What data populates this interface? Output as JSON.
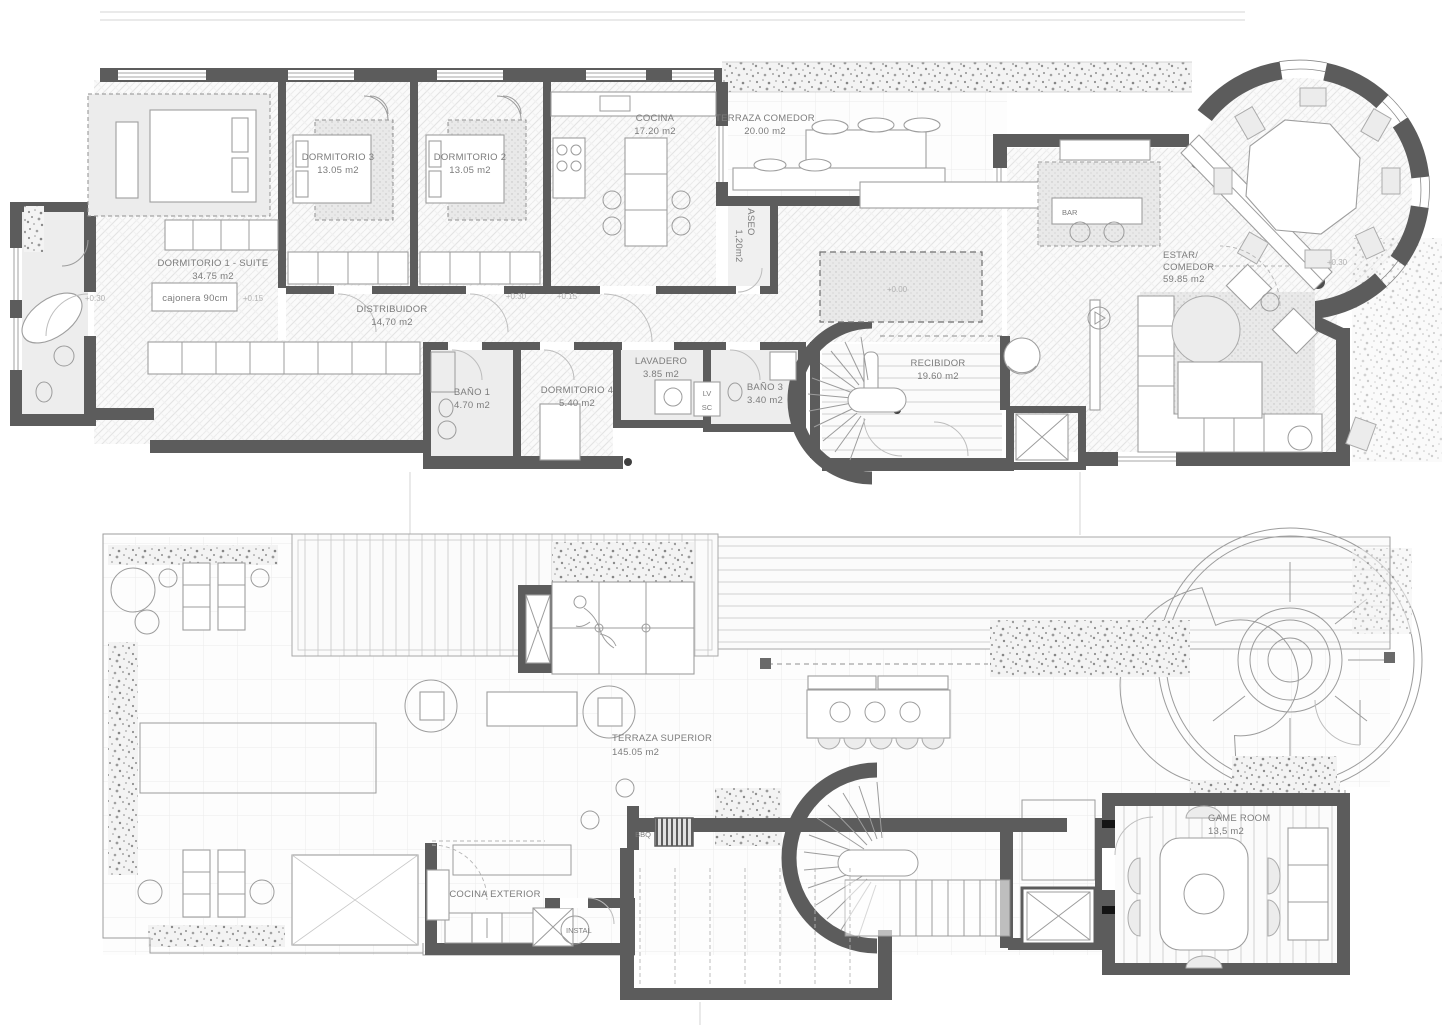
{
  "style": {
    "wall_color": "#5c5c5c",
    "label_color": "#7c7c7c",
    "level_label_color": "#b2b2b2"
  },
  "upper": {
    "rooms": {
      "dorm1": {
        "name": "DORMITORIO 1 - SUITE",
        "area": "34.75 m2"
      },
      "dorm3": {
        "name": "DORMITORIO 3",
        "area": "13.05 m2"
      },
      "dorm2": {
        "name": "DORMITORIO 2",
        "area": "13.05 m2"
      },
      "cocina": {
        "name": "COCINA",
        "area": "17.20 m2"
      },
      "terraza": {
        "name": "TERRAZA COMEDOR",
        "area": "20.00 m2"
      },
      "aseo": {
        "name": "ASEO",
        "area": "1,20m2"
      },
      "distribuidor": {
        "name": "DISTRIBUIDOR",
        "area": "14,70 m2"
      },
      "bano1": {
        "name": "BAÑO 1",
        "area": "4.70 m2"
      },
      "dorm4": {
        "name": "DORMITORIO 4",
        "area": "5.40 m2"
      },
      "lavadero": {
        "name": "LAVADERO",
        "area": "3.85 m2"
      },
      "bano3": {
        "name": "BAÑO 3",
        "area": "3.40 m2"
      },
      "recibidor": {
        "name": "RECIBIDOR",
        "area": "19.60 m2"
      },
      "estar": {
        "line1": "ESTAR/",
        "line2": "COMEDOR",
        "area": "59.85 m2"
      },
      "bar": {
        "name": "BAR"
      }
    },
    "ann": {
      "cajonera": "cajonera 90cm",
      "lv": "LV",
      "sc": "SC"
    },
    "levels": {
      "bath": "+0.30",
      "suite": "+0.15",
      "hall_a": "+0.30",
      "hall_b": "+0.15",
      "patio": "+0.00",
      "turret": "+0.30"
    }
  },
  "lower": {
    "rooms": {
      "terraza_superior": {
        "name": "TERRAZA SUPERIOR",
        "area": "145.05 m2"
      },
      "game_room": {
        "name": "GAME ROOM",
        "area": "13,5 m2"
      },
      "cocina_exterior": {
        "name": "COCINA EXTERIOR"
      },
      "instal": {
        "name": "INSTAL"
      },
      "bbq": {
        "name": "BBQ"
      }
    }
  }
}
